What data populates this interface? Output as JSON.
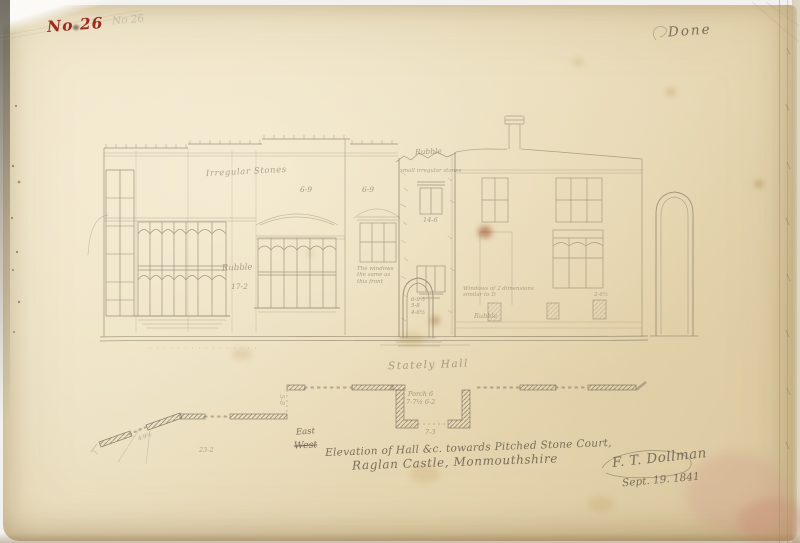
{
  "page": {
    "number_red": "No 26",
    "number_pencil": "No 26",
    "done_note": "Done"
  },
  "elevation": {
    "label_irregular_stones": "Irregular Stones",
    "label_rubble_wall": "Rubble",
    "dim_wall_height": "17-2",
    "dim_bay_left": "6-9",
    "dim_bay_right": "6-9",
    "note_bay_1": "The windows",
    "note_bay_2": "the same as",
    "note_bay_3": "this front",
    "tower": {
      "label_top": "Rubble",
      "note_small_stones": "small irregular stones",
      "dim_window": "14-6",
      "door_dims": [
        "6-9½",
        "5-8",
        "4-6½"
      ]
    },
    "right_block": {
      "note_windows_1": "Windows of 2 dimensions",
      "note_windows_2": "similar to D",
      "label_rubble": "Rubble",
      "dim_niche": "2-6½"
    }
  },
  "plan": {
    "title": "Stately Hall",
    "porch_line1": "Porch 6",
    "porch_line2": "7-7½  6-2",
    "dim_porch": "7-3",
    "dim_left": "23-2",
    "dim_jog": "5-8",
    "dim_angle": "4-9½"
  },
  "caption": {
    "direction_new": "East",
    "direction_struck": "West",
    "line1": "Elevation of Hall &c. towards Pitched Stone Court,",
    "line2": "Raglan Castle, Monmouthshire",
    "signature": "F. T. Dollman",
    "date": "Sept. 19. 1841"
  },
  "colors": {
    "paper": "#e9dbbc",
    "pencil": "#6a604e",
    "red_ink": "#9c2b1f"
  }
}
